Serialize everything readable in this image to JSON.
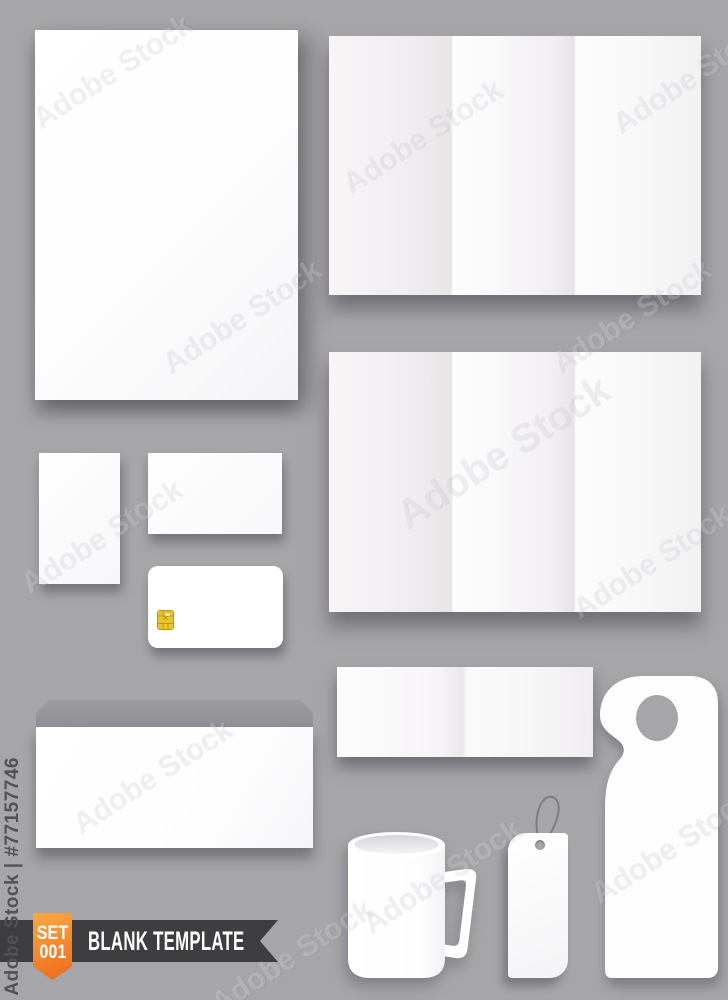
{
  "canvas": {
    "width": 728,
    "height": 1000,
    "background": "#a6a6a9"
  },
  "watermarks": {
    "side_text": "Adobe Stock | #77157746",
    "diagonal_text": "Adobe Stock"
  },
  "ribbon": {
    "badge_line1": "SET",
    "badge_line2": "001",
    "title": "BLANK TEMPLATE",
    "badge_gradient_start": "#f9a943",
    "badge_gradient_end": "#ee6c1e",
    "band_color": "#3e3d40",
    "text_color": "#ffffff"
  },
  "items": [
    "a4-sheet",
    "trifold-brochure-top",
    "trifold-brochure-middle",
    "vertical-card",
    "business-card",
    "credit-card",
    "credit-card-chip",
    "envelope",
    "bifold-card",
    "door-hanger",
    "mug",
    "price-tag"
  ],
  "colors": {
    "background": "#a6a6a9",
    "paper": "#ffffff",
    "fold_shade": "#e8e5e7",
    "envelope_flap": "#95959a",
    "chip_gold": "#e9c52d",
    "chip_lines": "#bf9712",
    "tag_string": "#7c7c82",
    "shadow": "rgba(55,55,65,0.45)"
  }
}
